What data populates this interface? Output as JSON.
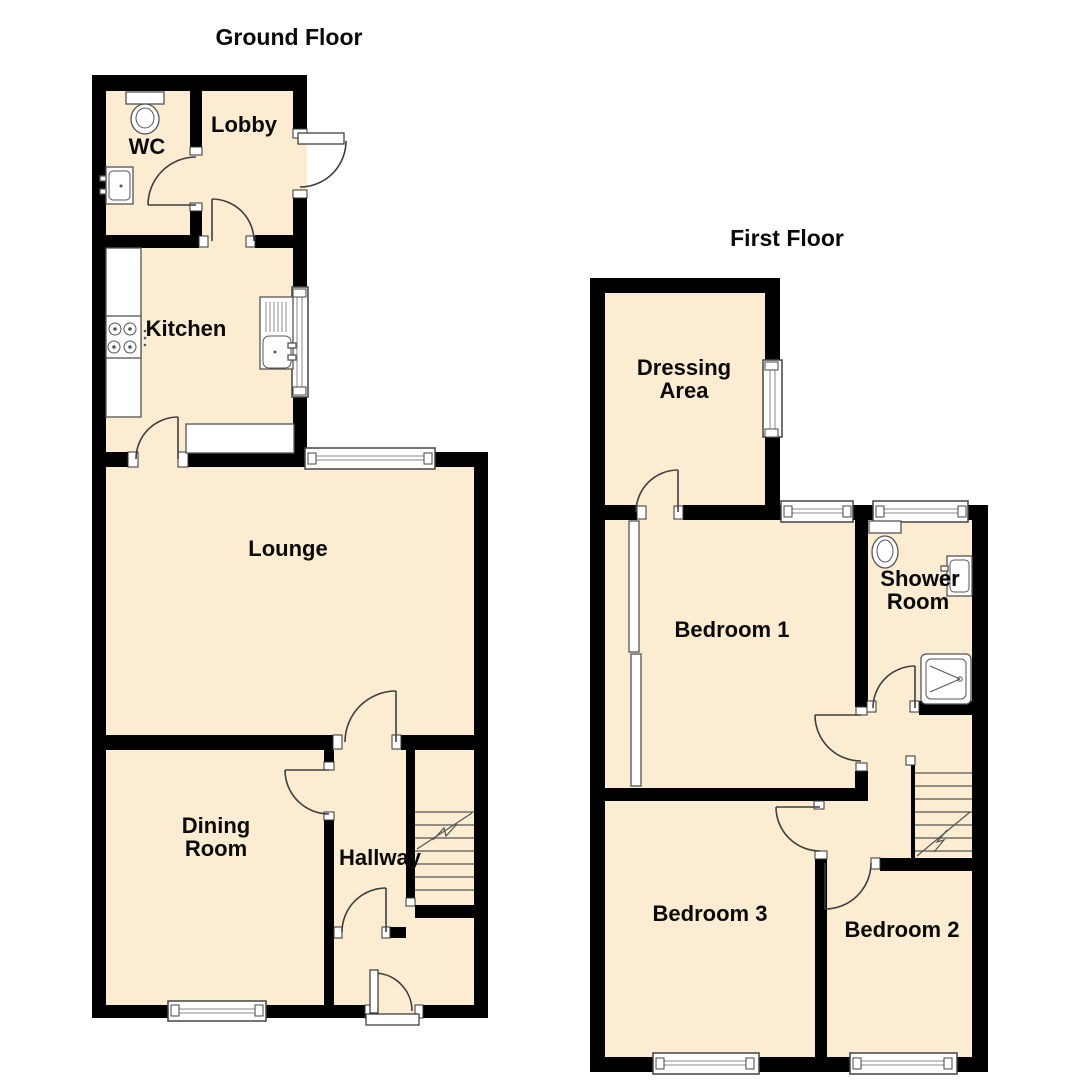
{
  "ground": {
    "title": "Ground Floor",
    "rooms": {
      "wc": "WC",
      "lobby": "Lobby",
      "kitchen": "Kitchen",
      "lounge": "Lounge",
      "dining": {
        "line1": "Dining",
        "line2": "Room"
      },
      "hallway": "Hallway"
    }
  },
  "first": {
    "title": "First Floor",
    "rooms": {
      "dressing": {
        "line1": "Dressing",
        "line2": "Area"
      },
      "bedroom1": "Bedroom 1",
      "shower": {
        "line1": "Shower",
        "line2": "Room"
      },
      "bedroom3": "Bedroom 3",
      "bedroom2": "Bedroom 2"
    }
  },
  "colors": {
    "wall": "#000000",
    "floor": "#FBECD2",
    "background": "#ffffff"
  }
}
